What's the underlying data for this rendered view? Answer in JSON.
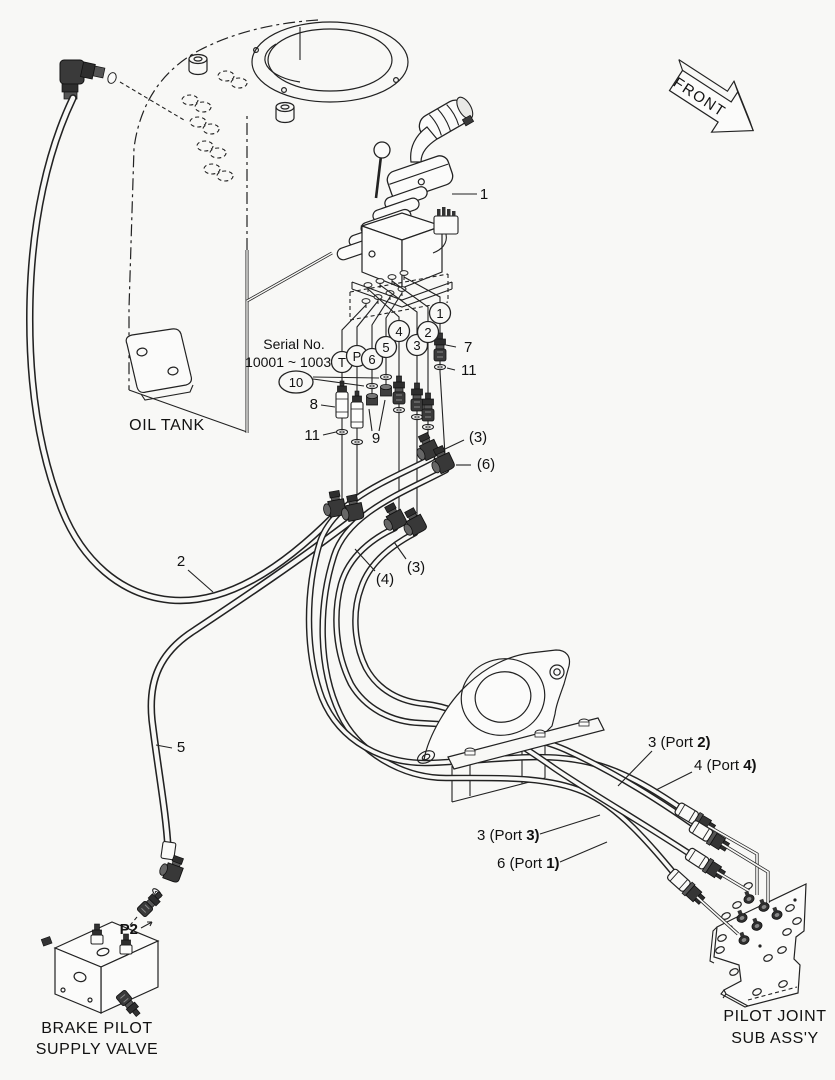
{
  "front_arrow": {
    "label": "FRONT"
  },
  "oil_tank": {
    "label": "OIL TANK"
  },
  "serial": {
    "line1": "Serial No.",
    "line2": "10001 ~ 10031"
  },
  "joystick": {
    "callout": "1"
  },
  "hoses": {
    "tank_hose": "2",
    "supply_hose": "5"
  },
  "fittings": {
    "item7": "7",
    "item8": "8",
    "item9": "9",
    "item10": "10",
    "item11_upper": "11",
    "item11_lower": "11"
  },
  "hose_qty": {
    "port2_elbow": "(3)",
    "port1_elbow": "(6)",
    "port3_hose": "(3)",
    "port4_hose": "(4)"
  },
  "ports": {
    "t": "T",
    "p": "P",
    "p6": "6",
    "p5": "5",
    "p4": "4",
    "p3": "3",
    "p2": "2",
    "p1": "1"
  },
  "connections": [
    {
      "text": "3 (Port ",
      "bold": "2)"
    },
    {
      "text": "4 (Port ",
      "bold": "4)"
    },
    {
      "text": "3 (Port ",
      "bold": "3)"
    },
    {
      "text": "6 (Port ",
      "bold": "1)"
    }
  ],
  "brake_valve": {
    "port": "P2",
    "line1": "BRAKE PILOT",
    "line2": "SUPPLY VALVE"
  },
  "pilot_joint": {
    "line1": "PILOT JOINT",
    "line2": "SUB ASS'Y"
  }
}
